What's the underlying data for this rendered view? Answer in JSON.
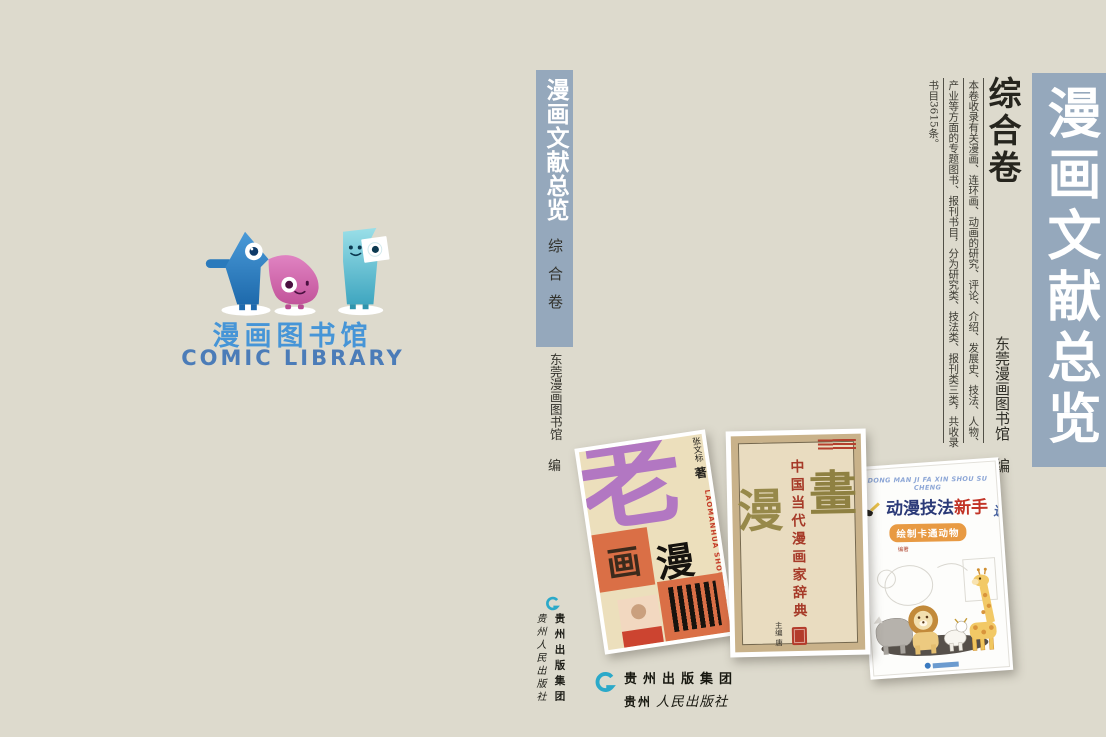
{
  "page": {
    "background_color": "#dddacd",
    "bar_color": "#95a8bc",
    "accent_blue": "#4695d7",
    "publisher_teal": "#2ba9c9"
  },
  "back_cover": {
    "logo_title_cn": "漫画图书馆",
    "logo_title_en": "COMIC LIBRARY",
    "mascot_icons": [
      "blue-pointer-mascot",
      "pink-wave-mascot",
      "teal-flag-mascot"
    ]
  },
  "spine": {
    "series_title": "漫画文献总览",
    "volume": "综合卷",
    "editor": "东莞漫画图书馆",
    "editor_role": "编",
    "publisher_group": "贵州出版集团",
    "publisher": "贵州人民出版社"
  },
  "front_cover": {
    "series_title": "漫画文献总览",
    "volume": "综合卷",
    "intro_col_1": "本卷收录有关漫画、连环画、动画的研究、评论、介绍、发展史、技法、人物、",
    "intro_col_2": "产业等方面的专题图书、报刊书目，分为研究类、技法类、报刊类三类，共收录",
    "intro_col_3": "书目3615条。",
    "editor": "东莞漫画图书馆",
    "editor_role": "编",
    "publisher_group": "贵州出版集团",
    "publisher_prefix": "贵州",
    "publisher_script": "人民出版社"
  },
  "books": {
    "book1": {
      "big_char": "老",
      "collage_char_a": "画",
      "collage_char_b": "漫",
      "author": "张文标",
      "author_role": "著",
      "pinyin": "LAOMANHUA SHOUCANG"
    },
    "book2": {
      "title": "中国当代漫画家辞典",
      "seal_char_left": "漫",
      "seal_char_right": "畫",
      "editor_line": "主编 唐"
    },
    "book3": {
      "pinyin": "DONG MAN JI FA XIN SHOU SU CHENG",
      "title_main": "动漫技法",
      "title_accent": "新手",
      "title_tail": "速成",
      "banner": "绘制卡通动物",
      "byline": "编著"
    }
  }
}
